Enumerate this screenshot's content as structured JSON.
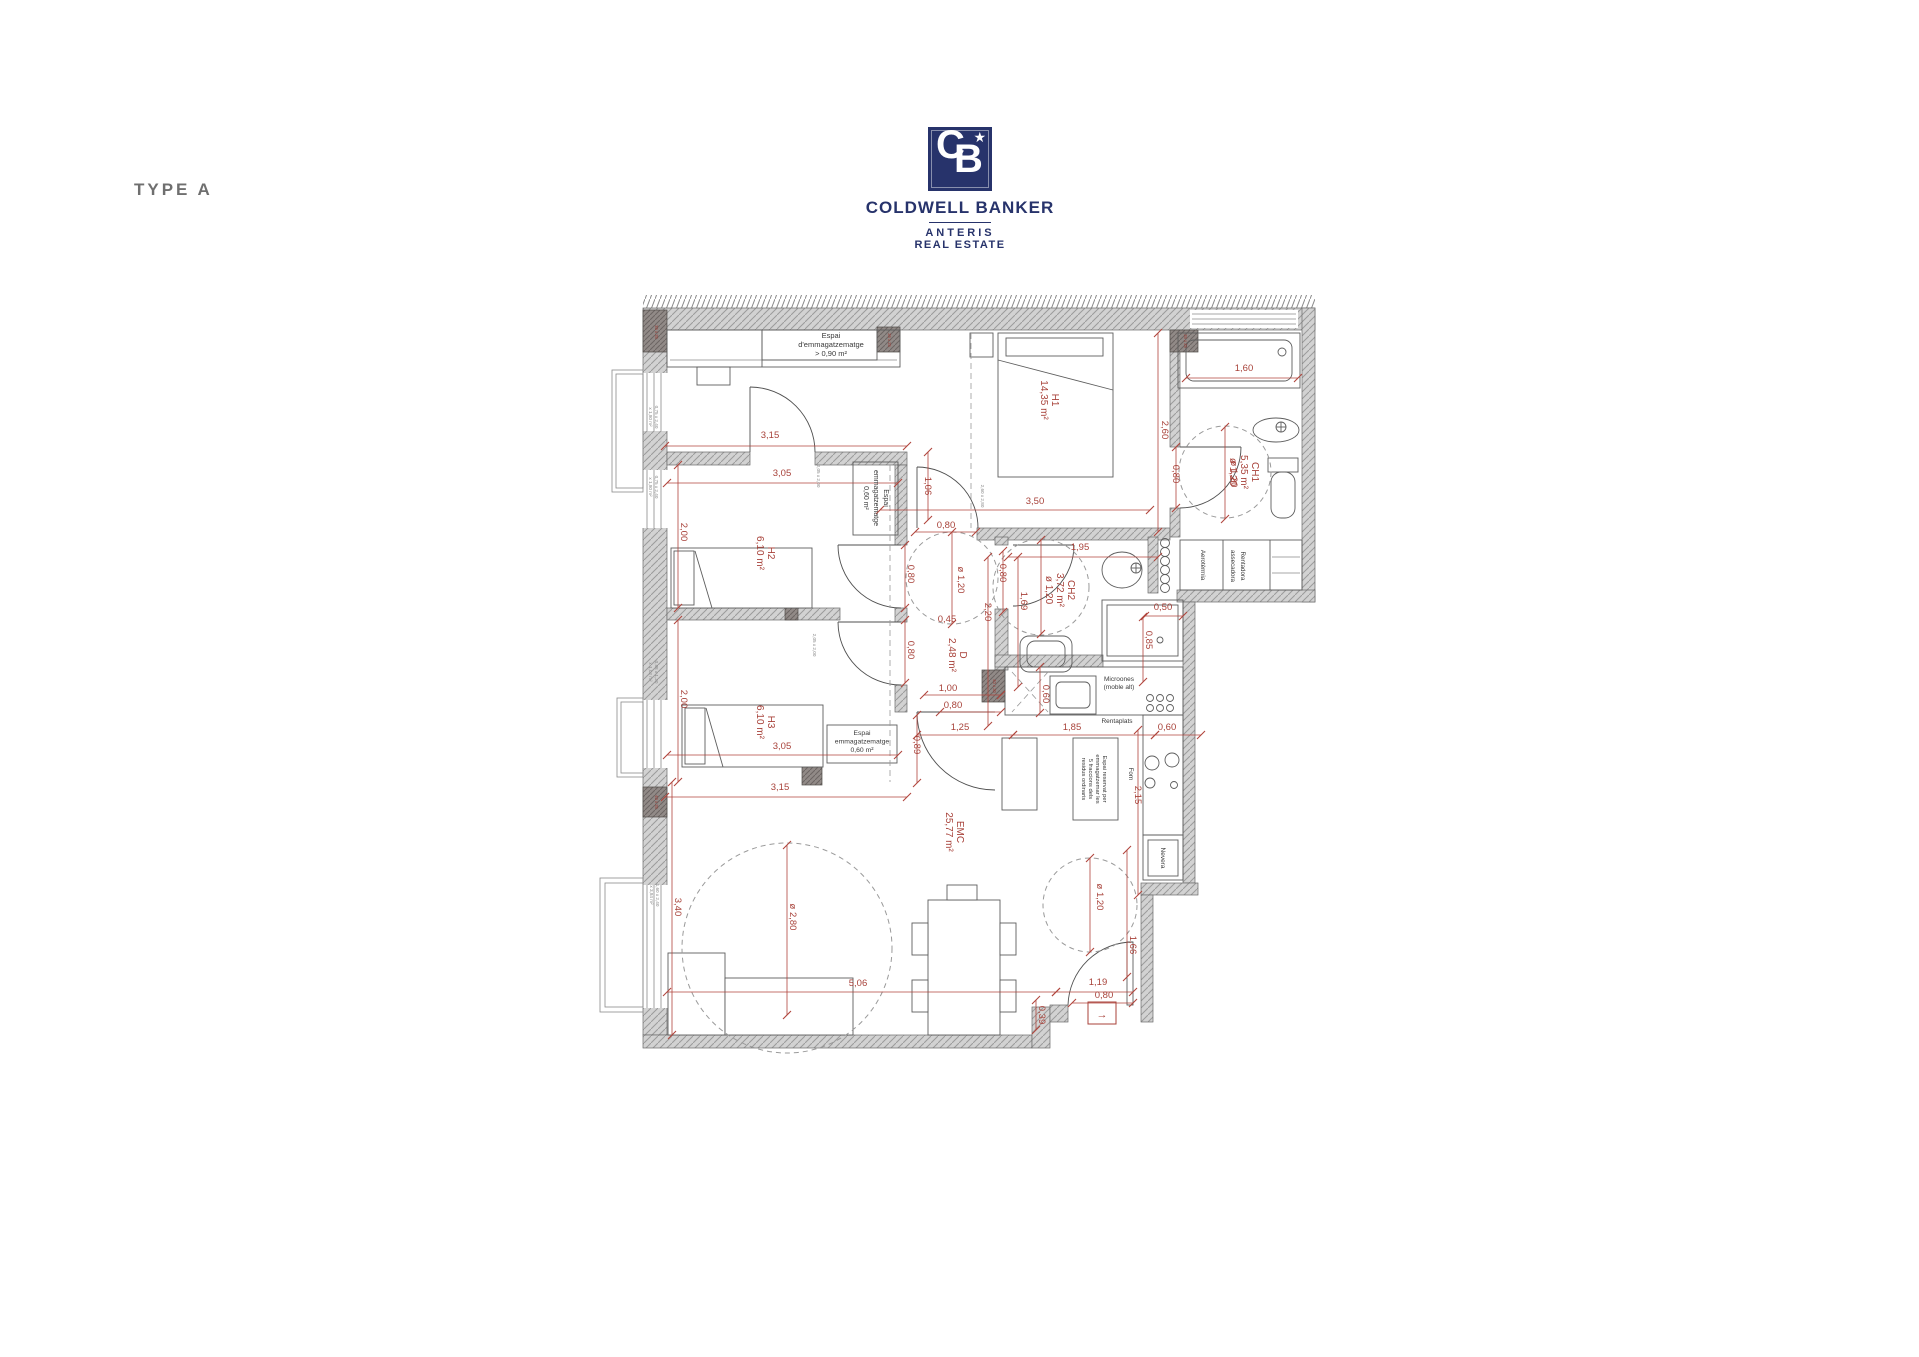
{
  "meta": {
    "type_label": "TYPE A"
  },
  "logo": {
    "monogram_c": "C",
    "monogram_b": "B",
    "star": "★",
    "brand": "COLDWELL BANKER",
    "sub1": "ANTERIS",
    "sub2": "REAL ESTATE",
    "navy": "#27336b"
  },
  "colors": {
    "dim_red": "#a8423a",
    "wall_gray": "#d2d2d2",
    "pillar_gray": "#918a87"
  },
  "plan": {
    "entrance_marker": "→",
    "room_labels": [
      {
        "lines": [
          "H1",
          "14,35 m²"
        ],
        "x": 1052,
        "y": 400
      },
      {
        "lines": [
          "H2",
          "6,10 m²"
        ],
        "x": 768,
        "y": 553
      },
      {
        "lines": [
          "H3",
          "6,10 m²"
        ],
        "x": 768,
        "y": 722
      },
      {
        "lines": [
          "CH1",
          "5,35 m²",
          "ø 1,20"
        ],
        "x": 1252,
        "y": 472
      },
      {
        "lines": [
          "CH2",
          "3,72 m²",
          "ø 1,20"
        ],
        "x": 1068,
        "y": 590
      },
      {
        "lines": [
          "D",
          "2,48 m²"
        ],
        "x": 960,
        "y": 655
      },
      {
        "lines": [
          "EMC",
          "25,77 m²"
        ],
        "x": 957,
        "y": 832
      }
    ],
    "dim_labels": [
      {
        "t": "3,15",
        "x": 770,
        "y": 438
      },
      {
        "t": "3,05",
        "x": 782,
        "y": 476
      },
      {
        "t": "2,00",
        "x": 681,
        "y": 532,
        "rot": 1
      },
      {
        "t": "2,00",
        "x": 681,
        "y": 699,
        "rot": 1
      },
      {
        "t": "3,05",
        "x": 782,
        "y": 749
      },
      {
        "t": "3,15",
        "x": 780,
        "y": 790
      },
      {
        "t": "1,06",
        "x": 925,
        "y": 486,
        "rot": 1
      },
      {
        "t": "0,80",
        "x": 946,
        "y": 528
      },
      {
        "t": "0,80",
        "x": 908,
        "y": 574,
        "rot": 1
      },
      {
        "t": "ø 1,20",
        "x": 958,
        "y": 580,
        "rot": 1
      },
      {
        "t": "2,20",
        "x": 985,
        "y": 612,
        "rot": 1
      },
      {
        "t": "0,45",
        "x": 947,
        "y": 622
      },
      {
        "t": "0,80",
        "x": 908,
        "y": 650,
        "rot": 1
      },
      {
        "t": "3,50",
        "x": 1035,
        "y": 504
      },
      {
        "t": "2,60",
        "x": 1162,
        "y": 430,
        "rot": 1
      },
      {
        "t": "0,80",
        "x": 1173,
        "y": 474,
        "rot": 1
      },
      {
        "t": "1,60",
        "x": 1244,
        "y": 371
      },
      {
        "t": "ø 1,20",
        "x": 1231,
        "y": 474,
        "rot": 1
      },
      {
        "t": "1,95",
        "x": 1080,
        "y": 550
      },
      {
        "t": "0,80",
        "x": 1000,
        "y": 573,
        "rot": 1
      },
      {
        "t": "1,69",
        "x": 1021,
        "y": 601,
        "rot": 1
      },
      {
        "t": "0,50",
        "x": 1163,
        "y": 610
      },
      {
        "t": "0,85",
        "x": 1146,
        "y": 640,
        "rot": 1
      },
      {
        "t": "1,00",
        "x": 948,
        "y": 691
      },
      {
        "t": "0,80",
        "x": 953,
        "y": 708
      },
      {
        "t": "1,25",
        "x": 960,
        "y": 730
      },
      {
        "t": "0,89",
        "x": 914,
        "y": 745,
        "rot": 1
      },
      {
        "t": "1,85",
        "x": 1072,
        "y": 730
      },
      {
        "t": "0,60",
        "x": 1167,
        "y": 730
      },
      {
        "t": "0,60",
        "x": 1043,
        "y": 694,
        "rot": 1
      },
      {
        "t": "2,15",
        "x": 1135,
        "y": 795,
        "rot": 1
      },
      {
        "t": "3,40",
        "x": 675,
        "y": 907,
        "rot": 1
      },
      {
        "t": "ø 2,80",
        "x": 790,
        "y": 917,
        "rot": 1
      },
      {
        "t": "5,06",
        "x": 858,
        "y": 986
      },
      {
        "t": "ø 1,20",
        "x": 1097,
        "y": 897,
        "rot": 1
      },
      {
        "t": "1,66",
        "x": 1130,
        "y": 945,
        "rot": 1
      },
      {
        "t": "1,19",
        "x": 1098,
        "y": 985
      },
      {
        "t": "0,80",
        "x": 1104,
        "y": 998
      },
      {
        "t": "0,39",
        "x": 1039,
        "y": 1015,
        "rot": 1
      }
    ],
    "black_labels": [
      {
        "lines": [
          "Espai",
          "d'emmagatzematge",
          "> 0,90 m²"
        ],
        "x": 831,
        "y": 338,
        "rot": 0,
        "size": 7.5,
        "ls": 9
      },
      {
        "lines": [
          "Espai",
          "emmagatzematge",
          "0,60 m²"
        ],
        "x": 884,
        "y": 498,
        "rot": 1,
        "size": 7,
        "ls": 10
      },
      {
        "lines": [
          "Espai",
          "emmagatzematge",
          "0,60 m²"
        ],
        "x": 862,
        "y": 735,
        "rot": 0,
        "size": 6.8,
        "ls": 8.5
      },
      {
        "lines": [
          "Microones",
          "(moble alt)"
        ],
        "x": 1119,
        "y": 681,
        "rot": 0,
        "size": 6.5,
        "ls": 8
      },
      {
        "lines": [
          "Rentaplats"
        ],
        "x": 1117,
        "y": 723,
        "rot": 0,
        "size": 6.5,
        "ls": 8
      },
      {
        "lines": [
          "Espai reservat per",
          "emmagatzemar les",
          "5 fraccions dels",
          "residus ordinaris"
        ],
        "x": 1103,
        "y": 779,
        "rot": 1,
        "size": 5.8,
        "ls": 7
      },
      {
        "lines": [
          "Forn"
        ],
        "x": 1129,
        "y": 774,
        "rot": 1,
        "size": 6.2,
        "ls": 8
      },
      {
        "lines": [
          "Nevera"
        ],
        "x": 1161,
        "y": 858,
        "rot": 1,
        "size": 6.5,
        "ls": 8
      },
      {
        "lines": [
          "Aerotèrmia"
        ],
        "x": 1201,
        "y": 565,
        "rot": 1,
        "size": 6.2,
        "ls": 8
      },
      {
        "lines": [
          "Rentadora",
          "assecadora"
        ],
        "x": 1241,
        "y": 566,
        "rot": 1,
        "size": 6.2,
        "ls": 10
      }
    ],
    "tiny_labels": [
      {
        "lines": [
          "0,75 x 2,40",
          "x 1,80 m²"
        ],
        "x": 655,
        "y": 417
      },
      {
        "lines": [
          "0,75 x 2,40",
          "x 1,80 m²"
        ],
        "x": 655,
        "y": 487
      },
      {
        "lines": [
          "0,88 x 1,20",
          "x 1,02 m²"
        ],
        "x": 655,
        "y": 672
      },
      {
        "lines": [
          "1,60 x 2,40",
          "x 3,84 m²"
        ],
        "x": 656,
        "y": 895
      },
      {
        "lines": [
          "2,05 x 2,00"
        ],
        "x": 817,
        "y": 476
      },
      {
        "lines": [
          "2,05 x 2,00"
        ],
        "x": 813,
        "y": 645
      },
      {
        "lines": [
          "2,60 x 2,80"
        ],
        "x": 981,
        "y": 496
      }
    ],
    "pillar_labels": [
      {
        "t": "35 x 25",
        "x": 655,
        "y": 332
      },
      {
        "t": "35 x 25",
        "x": 888,
        "y": 340
      },
      {
        "t": "35 x 25",
        "x": 1184,
        "y": 341
      },
      {
        "t": "40 x 25",
        "x": 655,
        "y": 802
      },
      {
        "t": "40 x 30",
        "x": 993,
        "y": 686
      }
    ]
  }
}
